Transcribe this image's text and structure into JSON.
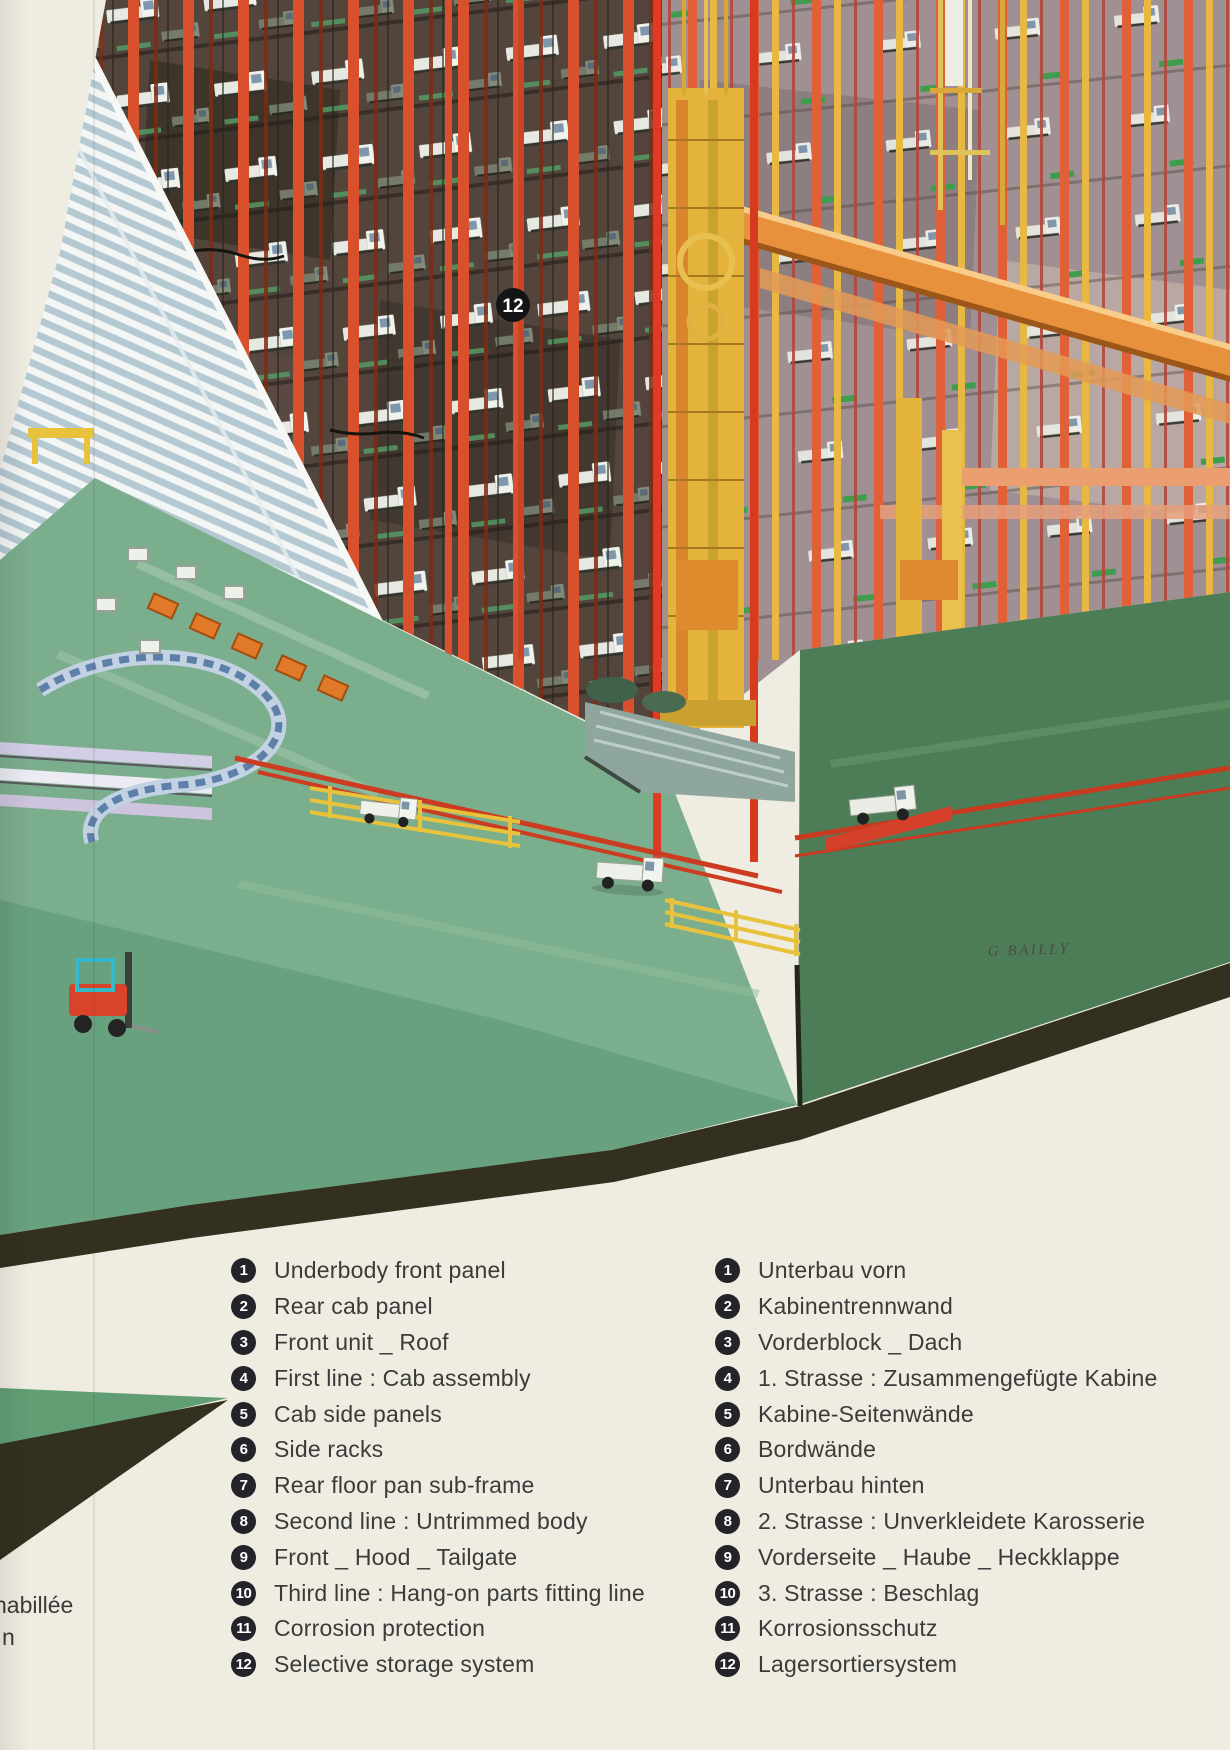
{
  "illustration": {
    "badge_12": "12",
    "signature": "G BAILLY"
  },
  "fragments": {
    "left_1": "habillée",
    "left_2": "n"
  },
  "legend": {
    "en": [
      {
        "num": "1",
        "label": "Underbody front panel"
      },
      {
        "num": "2",
        "label": "Rear cab panel"
      },
      {
        "num": "3",
        "label": "Front unit _ Roof"
      },
      {
        "num": "4",
        "label": "First line : Cab assembly"
      },
      {
        "num": "5",
        "label": "Cab side panels"
      },
      {
        "num": "6",
        "label": "Side racks"
      },
      {
        "num": "7",
        "label": "Rear floor pan sub-frame"
      },
      {
        "num": "8",
        "label": "Second line : Untrimmed body"
      },
      {
        "num": "9",
        "label": "Front _ Hood _ Tailgate"
      },
      {
        "num": "10",
        "label": "Third line : Hang-on parts fitting line"
      },
      {
        "num": "11",
        "label": "Corrosion protection"
      },
      {
        "num": "12",
        "label": "Selective storage system"
      }
    ],
    "de": [
      {
        "num": "1",
        "label": "Unterbau vorn"
      },
      {
        "num": "2",
        "label": "Kabinentrennwand"
      },
      {
        "num": "3",
        "label": "Vorderblock _ Dach"
      },
      {
        "num": "4",
        "label": "1. Strasse : Zusammengefügte Kabine"
      },
      {
        "num": "5",
        "label": "Kabine-Seitenwände"
      },
      {
        "num": "6",
        "label": "Bordwände"
      },
      {
        "num": "7",
        "label": "Unterbau hinten"
      },
      {
        "num": "8",
        "label": "2. Strasse : Unverkleidete Karosserie"
      },
      {
        "num": "9",
        "label": "Vorderseite _ Haube _ Heckklappe"
      },
      {
        "num": "10",
        "label": "3. Strasse : Beschlag"
      },
      {
        "num": "11",
        "label": "Korrosionsschutz"
      },
      {
        "num": "12",
        "label": "Lagersortiersystem"
      }
    ]
  },
  "colors": {
    "page_cream": "#efece1",
    "rack_red": "#d9512c",
    "floor_green": "#7bae8c",
    "border_dark": "#33301f",
    "crane_yellow": "#e3b33c"
  }
}
